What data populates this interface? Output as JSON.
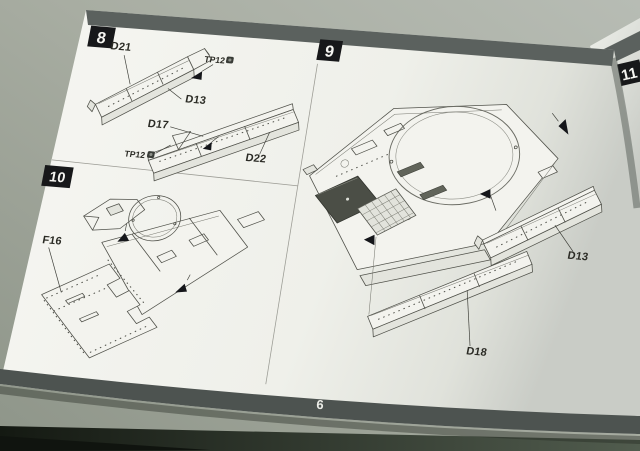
{
  "document": {
    "page_number": "6"
  },
  "steps": [
    {
      "number": "8",
      "part_labels": [
        "D21",
        "TP12",
        "D13",
        "D17",
        "TP12",
        "D22"
      ]
    },
    {
      "number": "9",
      "part_labels": [
        "D13",
        "D18"
      ]
    },
    {
      "number": "10",
      "part_labels": [
        "F16"
      ]
    },
    {
      "number": "11",
      "part_labels": []
    }
  ],
  "icons": {
    "fastener": "screw-icon"
  },
  "colors": {
    "paper": "#f4f4ef",
    "header_band": "#5b615e",
    "footer_band": "#4d5350",
    "step_square": "#17181a",
    "ink": "#50514a",
    "desk": "#a9aea3"
  }
}
